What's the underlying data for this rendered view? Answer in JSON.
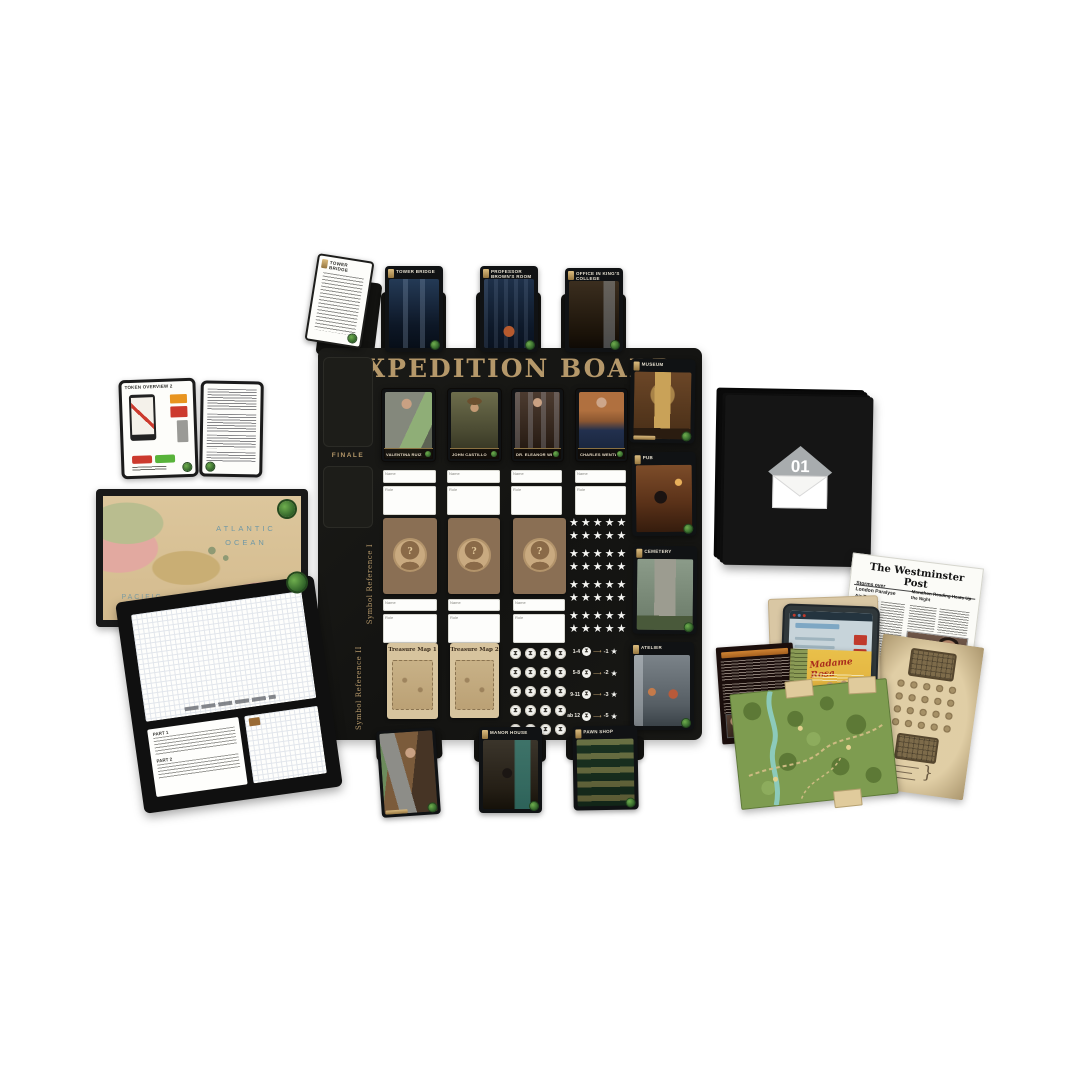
{
  "board": {
    "title": "EXPEDITION BOARD",
    "finale_label": "FINALE",
    "symbol_reference_1": "Symbol Reference I",
    "symbol_reference_2": "Symbol Reference II",
    "top_cards": [
      {
        "title": "Tower Bridge"
      },
      {
        "title": "TOWER BRIDGE"
      },
      {
        "title": "PROFESSOR BROWN'S ROOM"
      },
      {
        "title": "OFFICE IN KING'S COLLEGE"
      }
    ],
    "character_cards": [
      {
        "name": "VALENTINA RUIZ"
      },
      {
        "name": "JOHN CASTILLO"
      },
      {
        "name": "DR. ELEANOR WILDE"
      },
      {
        "name": "CHARLES WENTWORTH"
      }
    ],
    "field_labels": {
      "name": "Name",
      "role": "Role"
    },
    "mystery_card_symbol": "?",
    "treasure_cards": [
      {
        "title": "Treasure Map 1"
      },
      {
        "title": "Treasure Map 2"
      }
    ],
    "star_grid": {
      "rows": 8,
      "cols": 5
    },
    "token_grid": {
      "rows": 5,
      "cols": 4
    },
    "score_legend": [
      {
        "range": "1-4",
        "penalty": "-1"
      },
      {
        "range": "5-8",
        "penalty": "-2"
      },
      {
        "range": "9-11",
        "penalty": "-3"
      },
      {
        "range": "ab 12",
        "penalty": "-5"
      }
    ],
    "location_cards": [
      {
        "title": "MUSEUM"
      },
      {
        "title": "PUB"
      },
      {
        "title": "CEMETERY"
      },
      {
        "title": "ATELIER"
      },
      {
        "title": "MANOR HOUSE"
      },
      {
        "title": "PAWN SHOP"
      }
    ]
  },
  "left_items": {
    "overview_card": {
      "title": "TOKEN OVERVIEW 2"
    },
    "world_map": {
      "atlantic_label": "ATLANTIC OCEAN",
      "pacific_label": "PACIFIC OCEAN"
    },
    "notepad": {
      "part1_label": "PART 1",
      "part2_label": "PART 2"
    }
  },
  "right_items": {
    "envelope_number": "01",
    "newspaper": {
      "masthead": "The Westminster Post",
      "headline_left": "Storms over London Paralyse Air Traffic",
      "headline_right": "Marathon Reading Heats Up the Night"
    },
    "poster_title": "Madame Rosa"
  },
  "colors": {
    "board_black": "#161613",
    "title_gold": "#b5986a",
    "logo_green": "#3f7d36",
    "parchment": "#d6c193"
  }
}
